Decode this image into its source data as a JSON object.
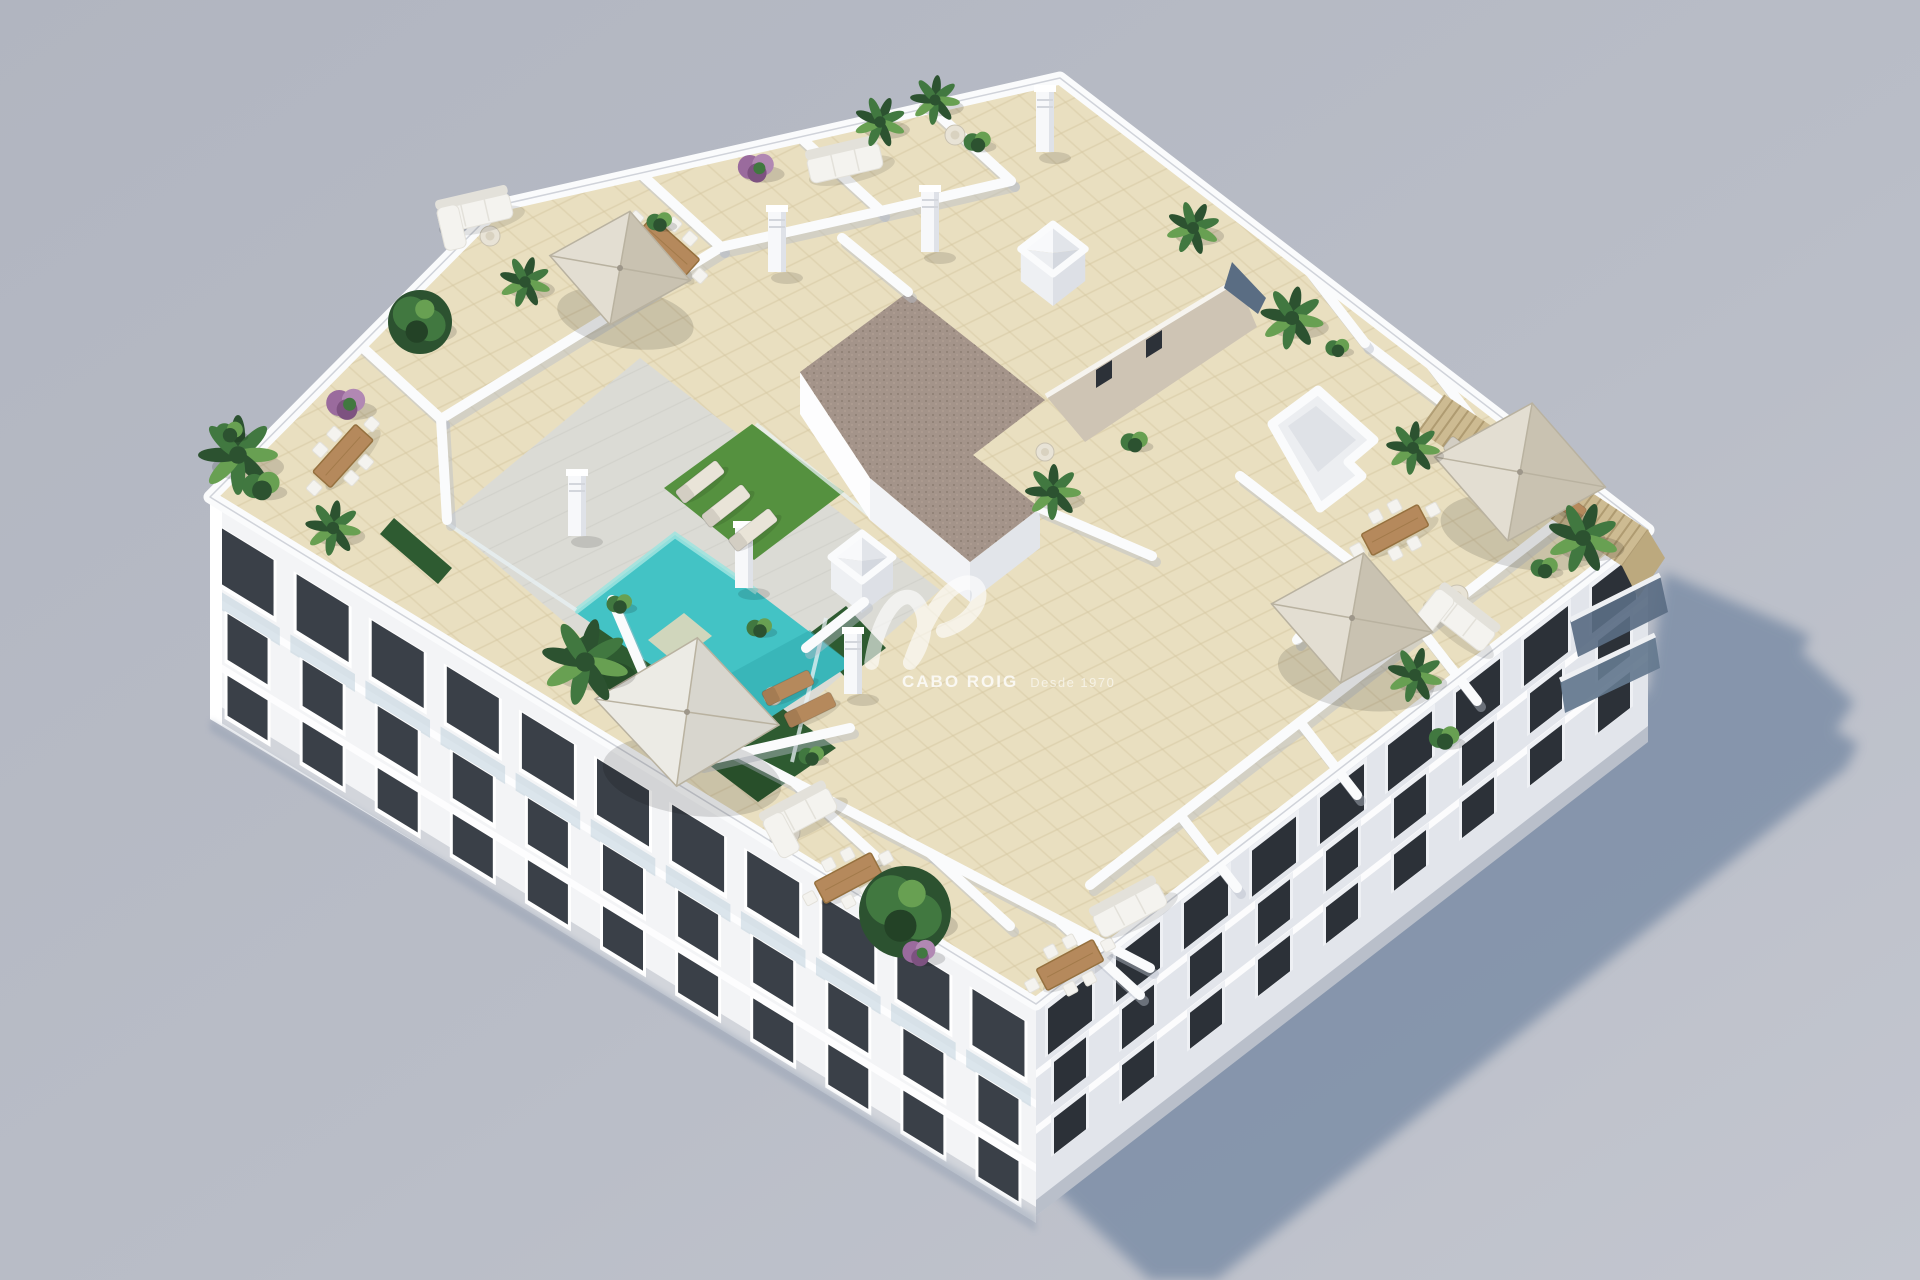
{
  "image": {
    "title": "Aerial 3D render of an apartment building with rooftop pool terraces",
    "width": 1920,
    "height": 1280
  },
  "watermark": {
    "brand": "CABO ROIG",
    "tagline": "Desde 1970"
  },
  "colors": {
    "background": "#b9bdc7",
    "background_light": "#c3c6cf",
    "background_dark": "#b1b5c0",
    "shadow": "#7f90a8",
    "facade_sun": "#f3f4f6",
    "facade_shade": "#e2e5eb",
    "facade_bright": "#ffffff",
    "slab_line": "#fdfdfe",
    "plinth_sun": "#d2d5db",
    "plinth_shade": "#b9bfca",
    "window_dark": "#3a4048",
    "window_darker": "#2c3138",
    "window_frame": "#ffffff",
    "glass": "#bfd2dc",
    "slate_glass": "#5a6d83",
    "slate_glass2": "#64788e",
    "parapet": "#fafbfc",
    "wall_shadow": "#b9bfca",
    "tile": "#e9dfc0",
    "tile_line": "#d5c7a1",
    "deck": "#dbdbd5",
    "deck_line": "#c9c9c2",
    "pool": "#43c3c5",
    "pool_light": "#9fe4df",
    "pool_deep": "#2fa9ae",
    "pool_step": "#e0d8ba",
    "lawn": "#55913f",
    "hedge": "#2e5b31",
    "gravel": "#a4948a",
    "gravel_dot": "#8b7c71",
    "greige_wall": "#cec4b4",
    "greige_shade": "#b9ad99",
    "wood": "#b5895c",
    "wood_dark": "#96713f",
    "pergola": "#cdbb92",
    "pergola_line": "#a8946a",
    "umbrella_light": "#e3ded2",
    "umbrella_shade": "#c9c2b1",
    "umbrella_line": "#b9b2a0",
    "white_soft": "#f1f2f4",
    "furniture_white": "#f4f3ef",
    "furniture_shade": "#e3e1da",
    "plant_dark": "#2c5230",
    "plant_mid": "#417840",
    "plant_light": "#68a052",
    "purple": "#9a6b9d",
    "purple_light": "#b188b3",
    "pot": "#c9a489"
  },
  "scene": {
    "roof": [
      [
        210,
        497
      ],
      [
        500,
        205
      ],
      [
        1060,
        78
      ],
      [
        1648,
        530
      ],
      [
        1036,
        1004
      ]
    ],
    "facade_sw": [
      [
        210,
        497
      ],
      [
        1036,
        1004
      ],
      [
        1036,
        1216
      ],
      [
        210,
        719
      ]
    ],
    "facade_se": [
      [
        1036,
        1004
      ],
      [
        1648,
        530
      ],
      [
        1648,
        730
      ],
      [
        1036,
        1216
      ]
    ],
    "ground_shadow": [
      [
        1032,
        1168
      ],
      [
        1150,
        1280
      ],
      [
        1216,
        1280
      ],
      [
        1846,
        768
      ],
      [
        1858,
        744
      ],
      [
        1836,
        730
      ],
      [
        1854,
        702
      ],
      [
        1802,
        652
      ],
      [
        1810,
        636
      ],
      [
        1786,
        624
      ],
      [
        1664,
        572
      ],
      [
        1648,
        690
      ],
      [
        1040,
        1158
      ]
    ],
    "deck": [
      [
        445,
        520
      ],
      [
        640,
        358
      ],
      [
        940,
        590
      ],
      [
        735,
        768
      ]
    ],
    "pool": [
      [
        675,
        535
      ],
      [
        575,
        612
      ],
      [
        748,
        732
      ],
      [
        852,
        664
      ],
      [
        757,
        592
      ]
    ],
    "pool_step": [
      [
        648,
        640
      ],
      [
        684,
        613
      ],
      [
        712,
        636
      ],
      [
        676,
        663
      ]
    ],
    "lawn": [
      [
        664,
        488
      ],
      [
        752,
        424
      ],
      [
        844,
        492
      ],
      [
        754,
        560
      ]
    ],
    "hedges": [
      [
        [
          560,
          652
        ],
        [
          636,
          600
        ],
        [
          836,
          748
        ],
        [
          758,
          802
        ]
      ],
      [
        [
          806,
          636
        ],
        [
          846,
          606
        ],
        [
          886,
          648
        ],
        [
          846,
          678
        ]
      ],
      [
        [
          394,
          518
        ],
        [
          452,
          568
        ],
        [
          438,
          584
        ],
        [
          380,
          534
        ]
      ]
    ],
    "gravel_roof": [
      [
        800,
        372
      ],
      [
        908,
        292
      ],
      [
        1045,
        400
      ],
      [
        973,
        455
      ],
      [
        1040,
        508
      ],
      [
        970,
        562
      ],
      [
        870,
        478
      ]
    ],
    "greige_wall": [
      [
        1046,
        396
      ],
      [
        1237,
        280
      ],
      [
        1257,
        327
      ],
      [
        1085,
        442
      ]
    ],
    "slate_patch": [
      [
        1224,
        288
      ],
      [
        1258,
        314
      ],
      [
        1266,
        298
      ],
      [
        1232,
        262
      ]
    ],
    "stairbox_outer": [
      [
        1272,
        424
      ],
      [
        1318,
        390
      ],
      [
        1374,
        440
      ],
      [
        1348,
        462
      ],
      [
        1362,
        476
      ],
      [
        1320,
        508
      ]
    ],
    "stairbox_inner": [
      [
        1288,
        426
      ],
      [
        1316,
        406
      ],
      [
        1356,
        440
      ],
      [
        1318,
        472
      ]
    ],
    "pergola": [
      [
        1445,
        395
      ],
      [
        1648,
        530
      ],
      [
        1622,
        566
      ],
      [
        1419,
        431
      ]
    ],
    "pergola_wedge": [
      [
        1648,
        530
      ],
      [
        1665,
        558
      ],
      [
        1638,
        598
      ],
      [
        1622,
        566
      ]
    ],
    "glass_balconies": [
      [
        [
          1570,
          620
        ],
        [
          1660,
          575
        ],
        [
          1668,
          612
        ],
        [
          1578,
          657
        ]
      ],
      [
        [
          1560,
          680
        ],
        [
          1655,
          635
        ],
        [
          1660,
          668
        ],
        [
          1565,
          713
        ]
      ]
    ],
    "walls": [
      [
        360,
        345,
        441,
        419
      ],
      [
        640,
        173,
        721,
        247
      ],
      [
        800,
        137,
        881,
        211
      ],
      [
        930,
        107,
        1011,
        181
      ],
      [
        441,
        419,
        721,
        247
      ],
      [
        721,
        247,
        881,
        211
      ],
      [
        881,
        211,
        1011,
        181
      ],
      [
        441,
        419,
        447,
        520
      ],
      [
        908,
        292,
        842,
        238
      ],
      [
        1040,
        508,
        1152,
        556
      ],
      [
        612,
        600,
        660,
        712
      ],
      [
        660,
        712,
        1150,
        968
      ],
      [
        795,
        783,
        875,
        856
      ],
      [
        930,
        853,
        1010,
        926
      ],
      [
        1060,
        922,
        1140,
        995
      ],
      [
        700,
        762,
        850,
        728
      ],
      [
        806,
        648,
        864,
        602
      ],
      [
        1090,
        885,
        1555,
        524
      ],
      [
        1180,
        815,
        1237,
        888
      ],
      [
        1300,
        722,
        1357,
        795
      ],
      [
        1420,
        628,
        1477,
        701
      ],
      [
        1365,
        343,
        1485,
        435
      ],
      [
        1485,
        435,
        1588,
        514
      ],
      [
        1310,
        272,
        1365,
        343
      ],
      [
        1430,
        364,
        1485,
        435
      ],
      [
        1240,
        476,
        1355,
        565
      ],
      [
        1355,
        565,
        1297,
        640
      ]
    ],
    "glass_fences": [
      [
        756,
        424,
        900,
        540
      ],
      [
        826,
        618,
        792,
        762
      ],
      [
        448,
        524,
        576,
        610
      ]
    ],
    "skylights": [
      [
        1053,
        249,
        52
      ],
      [
        862,
        557,
        50
      ]
    ],
    "chimneys": [
      [
        777,
        272
      ],
      [
        930,
        252
      ],
      [
        1045,
        152
      ],
      [
        577,
        536
      ],
      [
        744,
        588
      ],
      [
        853,
        694
      ]
    ],
    "tables": [
      [
        343,
        456,
        -48
      ],
      [
        668,
        247,
        42
      ],
      [
        1395,
        530,
        -28
      ],
      [
        1070,
        965,
        -28
      ],
      [
        848,
        878,
        -28
      ]
    ],
    "round_tables": [
      [
        490,
        236,
        10
      ],
      [
        787,
        832,
        13
      ],
      [
        773,
        696,
        9
      ],
      [
        955,
        135,
        10
      ],
      [
        1045,
        452,
        9
      ],
      [
        1457,
        596,
        11
      ]
    ],
    "sofas": [
      [
        475,
        213,
        -13,
        1
      ],
      [
        845,
        163,
        -13,
        0
      ],
      [
        800,
        815,
        -28,
        1
      ],
      [
        1130,
        910,
        -28,
        0
      ],
      [
        1460,
        620,
        38,
        1
      ]
    ],
    "loungers": [
      [
        700,
        482,
        -38,
        "pale"
      ],
      [
        726,
        506,
        -38,
        "pale"
      ],
      [
        753,
        530,
        -38,
        "pale"
      ],
      [
        788,
        688,
        -26,
        "wood"
      ],
      [
        810,
        710,
        -26,
        "wood"
      ],
      [
        1562,
        500,
        38,
        "wood"
      ],
      [
        1468,
        458,
        38,
        "pale"
      ]
    ],
    "umbrellas": [
      [
        620,
        268,
        115,
        10,
        ""
      ],
      [
        687,
        712,
        150,
        8,
        "#ecebe5"
      ],
      [
        1520,
        472,
        140,
        10,
        ""
      ],
      [
        1352,
        618,
        132,
        10,
        ""
      ]
    ],
    "plants": [
      [
        238,
        455,
        40,
        "palm"
      ],
      [
        262,
        486,
        22,
        "bush"
      ],
      [
        230,
        432,
        16,
        "bush"
      ],
      [
        333,
        528,
        28,
        "palm"
      ],
      [
        347,
        403,
        26,
        "purple"
      ],
      [
        420,
        322,
        32,
        "tree"
      ],
      [
        525,
        282,
        26,
        "palm"
      ],
      [
        660,
        222,
        15,
        "bush"
      ],
      [
        585,
        662,
        44,
        "palm"
      ],
      [
        620,
        604,
        15,
        "bush"
      ],
      [
        757,
        167,
        24,
        "purple"
      ],
      [
        880,
        122,
        26,
        "palm"
      ],
      [
        935,
        100,
        25,
        "palm"
      ],
      [
        978,
        142,
        16,
        "bush"
      ],
      [
        1053,
        492,
        28,
        "palm"
      ],
      [
        1135,
        442,
        16,
        "bush"
      ],
      [
        1193,
        228,
        27,
        "palm"
      ],
      [
        1292,
        318,
        32,
        "palm"
      ],
      [
        1338,
        348,
        14,
        "bush"
      ],
      [
        1413,
        448,
        27,
        "palm"
      ],
      [
        1583,
        538,
        36,
        "palm"
      ],
      [
        1545,
        568,
        16,
        "bush"
      ],
      [
        1415,
        675,
        28,
        "palm"
      ],
      [
        1445,
        738,
        18,
        "bush"
      ],
      [
        905,
        912,
        46,
        "tree"
      ],
      [
        920,
        952,
        22,
        "purple"
      ],
      [
        760,
        628,
        15,
        "bush"
      ],
      [
        812,
        756,
        15,
        "bush"
      ]
    ],
    "facade_sw_windows": {
      "count": 11,
      "rows": [
        {
          "o": 24,
          "h": 56,
          "w": 52,
          "glass": true
        },
        {
          "o": 106,
          "h": 46,
          "w": 40,
          "glass": false
        },
        {
          "o": 168,
          "h": 40,
          "w": 40,
          "glass": false
        }
      ]
    },
    "facade_se_windows": {
      "count": 9,
      "rows": [
        {
          "o": 14,
          "h": 46,
          "w": 44,
          "glass": false
        },
        {
          "o": 72,
          "h": 40,
          "w": 32,
          "glass": false
        },
        {
          "o": 128,
          "h": 36,
          "w": 32,
          "glass": false
        }
      ]
    }
  }
}
